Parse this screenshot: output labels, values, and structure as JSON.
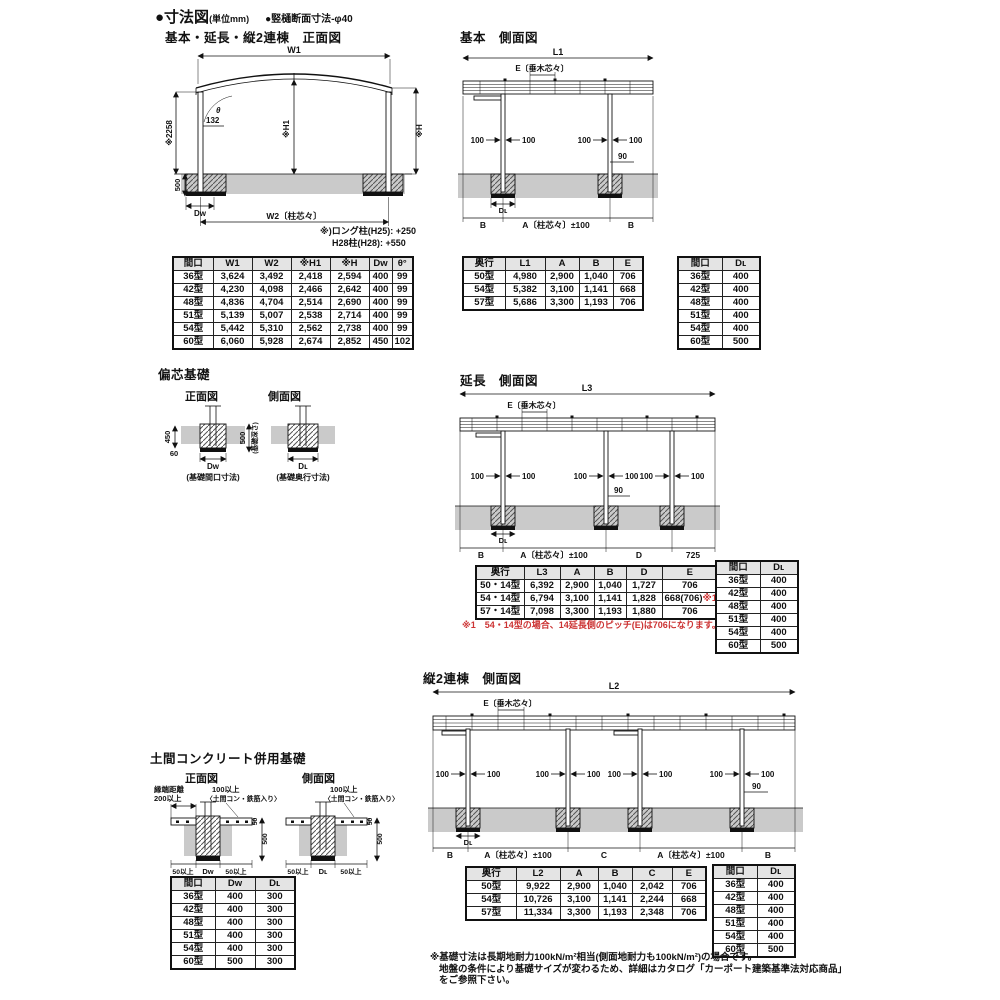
{
  "page": {
    "title": "●寸法図",
    "unit": "(単位mm)",
    "subnote": "●竪樋断面寸法-φ40"
  },
  "sections": {
    "front": "基本・延長・縦2連棟　正面図",
    "basic_side": "基本　側面図",
    "henshin": "偏芯基礎",
    "ext_side": "延長　側面図",
    "rento_side": "縦2連棟　側面図",
    "doma": "土間コンクリート併用基礎",
    "front_label": "正面図",
    "side_label": "側面図"
  },
  "common": {
    "e": "E〔垂木芯々〕",
    "p100": "100",
    "n90": "90",
    "b": "B",
    "a": "A〔柱芯々〕±100",
    "dw": "Dᴡ",
    "dl": "Dʟ"
  },
  "front_view": {
    "w1": "W1",
    "w2": "W2〔柱芯々〕",
    "h2258": "※2258",
    "v500": "500",
    "d132": "132",
    "theta": "θ",
    "h1": "※H1",
    "h": "※H",
    "note1": "※)ロング柱(H25): +250",
    "note2": "H28柱(H28): +550"
  },
  "basic_view": {
    "l1": "L1"
  },
  "ext_view": {
    "l3": "L3",
    "d": "D",
    "v725": "725"
  },
  "rento_view": {
    "l2": "L2",
    "c": "C"
  },
  "henshin_view": {
    "v450": "450",
    "v60": "60",
    "v500": "500",
    "depth": "(基礎深さ)",
    "cap_front": "(基礎間口寸法)",
    "cap_side": "(基礎奥行寸法)"
  },
  "doma_view": {
    "edge1": "縁端距離",
    "edge2": "200以上",
    "min100": "100以上",
    "rebar": "〈土間コン・鉄筋入り〉",
    "v50": "50",
    "v500": "500",
    "min50": "50以上"
  },
  "tables": {
    "front": {
      "headers": [
        "間口",
        "W1",
        "W2",
        "※H1",
        "※H",
        "Dᴡ",
        "θ°"
      ],
      "rows": [
        [
          "36型",
          "3,624",
          "3,492",
          "2,418",
          "2,594",
          "400",
          "99"
        ],
        [
          "42型",
          "4,230",
          "4,098",
          "2,466",
          "2,642",
          "400",
          "99"
        ],
        [
          "48型",
          "4,836",
          "4,704",
          "2,514",
          "2,690",
          "400",
          "99"
        ],
        [
          "51型",
          "5,139",
          "5,007",
          "2,538",
          "2,714",
          "400",
          "99"
        ],
        [
          "54型",
          "5,442",
          "5,310",
          "2,562",
          "2,738",
          "400",
          "99"
        ],
        [
          "60型",
          "6,060",
          "5,928",
          "2,674",
          "2,852",
          "450",
          "102"
        ]
      ]
    },
    "basic_side": {
      "headers": [
        "奥行",
        "L1",
        "A",
        "B",
        "E"
      ],
      "rows": [
        [
          "50型",
          "4,980",
          "2,900",
          "1,040",
          "706"
        ],
        [
          "54型",
          "5,382",
          "3,100",
          "1,141",
          "668"
        ],
        [
          "57型",
          "5,686",
          "3,300",
          "1,193",
          "706"
        ]
      ]
    },
    "maguchi_dl": {
      "headers": [
        "間口",
        "Dʟ"
      ],
      "rows": [
        [
          "36型",
          "400"
        ],
        [
          "42型",
          "400"
        ],
        [
          "48型",
          "400"
        ],
        [
          "51型",
          "400"
        ],
        [
          "54型",
          "400"
        ],
        [
          "60型",
          "500"
        ]
      ]
    },
    "extension": {
      "headers": [
        "奥行",
        "L3",
        "A",
        "B",
        "D",
        "E"
      ],
      "red_marker": "※1",
      "rows": [
        [
          "50・14型",
          "6,392",
          "2,900",
          "1,040",
          "1,727",
          "706"
        ],
        [
          "54・14型",
          "6,794",
          "3,100",
          "1,141",
          "1,828",
          "668(706)※1"
        ],
        [
          "57・14型",
          "7,098",
          "3,300",
          "1,193",
          "1,880",
          "706"
        ]
      ],
      "note": "※1　54・14型の場合、14延長側のピッチ(E)は706になります。"
    },
    "rento": {
      "headers": [
        "奥行",
        "L2",
        "A",
        "B",
        "C",
        "E"
      ],
      "rows": [
        [
          "50型",
          "9,922",
          "2,900",
          "1,040",
          "2,042",
          "706"
        ],
        [
          "54型",
          "10,726",
          "3,100",
          "1,141",
          "2,244",
          "668"
        ],
        [
          "57型",
          "11,334",
          "3,300",
          "1,193",
          "2,348",
          "706"
        ]
      ]
    },
    "doma": {
      "headers": [
        "間口",
        "Dᴡ",
        "Dʟ"
      ],
      "rows": [
        [
          "36型",
          "400",
          "300"
        ],
        [
          "42型",
          "400",
          "300"
        ],
        [
          "48型",
          "400",
          "300"
        ],
        [
          "51型",
          "400",
          "300"
        ],
        [
          "54型",
          "400",
          "300"
        ],
        [
          "60型",
          "500",
          "300"
        ]
      ]
    }
  },
  "footnote": {
    "line1": "※基礎寸法は長期地耐力100kN/m²相当(側面地耐力も100kN/m²)の場合です。",
    "line2": "地盤の条件により基礎サイズが変わるため、詳細はカタログ「カーポート建築基準法対応商品」",
    "line3": "をご参照下さい。"
  },
  "colors": {
    "accent_red": "#cc3333",
    "ground_gray": "#cacaca",
    "table_header_gray": "#e4e4e4"
  }
}
